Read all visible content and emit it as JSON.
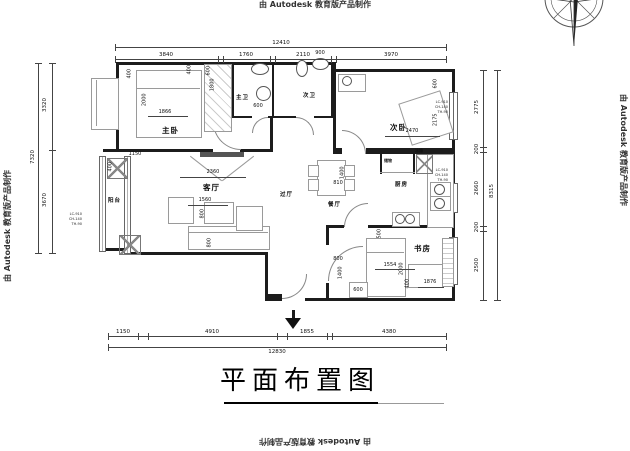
{
  "watermark": {
    "text": "由 Autodesk 教育版产品制作"
  },
  "title": "平面布置图",
  "rooms": {
    "master_bedroom": "主卧",
    "master_bath": "主卫",
    "second_bath": "次卫",
    "second_bedroom": "次卧",
    "balcony": "阳台",
    "living_room": "客厅",
    "hallway": "过厅",
    "dining_room": "餐厅",
    "kitchen": "厨房",
    "storage": "储物",
    "fridge": "冰箱",
    "study": "书房"
  },
  "dims": {
    "top": {
      "total": "12410",
      "segments": [
        "3840",
        "1760",
        "2110",
        "3970"
      ]
    },
    "bottom": {
      "total": "12830",
      "segments": [
        "1150",
        "4910",
        "1855",
        "4380"
      ]
    },
    "left": {
      "total": "7320",
      "segments": [
        "3320",
        "3670"
      ]
    },
    "right": {
      "total": "8315",
      "segments": [
        "2775",
        "200",
        "2660",
        "200",
        "2500"
      ]
    }
  },
  "interior_dims": [
    "400",
    "2000",
    "1866",
    "400",
    "600",
    "1800",
    "600",
    "900",
    "600",
    "2175",
    "2470",
    "1150",
    "400",
    "2360",
    "1560",
    "800",
    "800",
    "1400",
    "810",
    "500",
    "1554",
    "2000",
    "400",
    "1876",
    "800",
    "1400",
    "600"
  ],
  "window_label": {
    "l1": "LC-910",
    "l2": "CH-140",
    "l3": "TH-90"
  }
}
